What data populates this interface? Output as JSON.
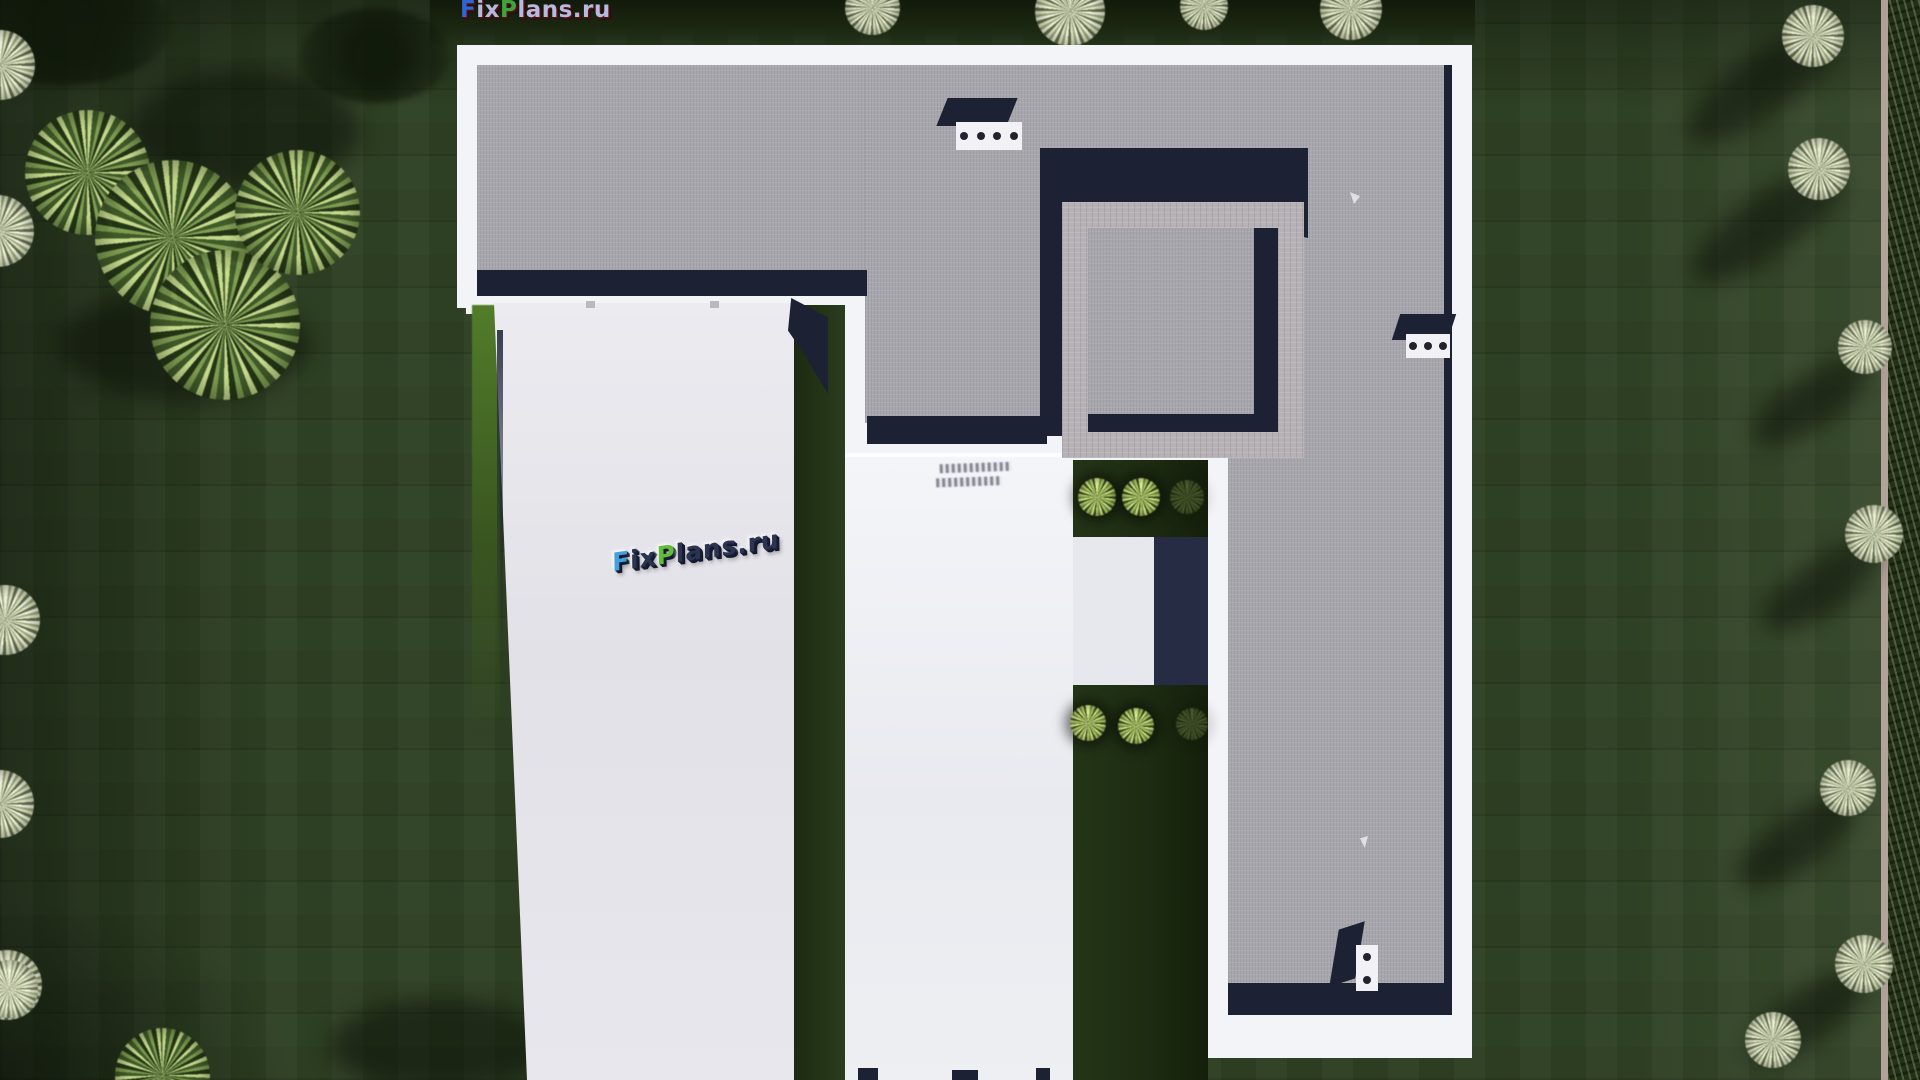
{
  "site": {
    "name": "FixPlans.ru"
  },
  "logo": {
    "full": "FixPlans.ru",
    "parts": [
      {
        "text": "F",
        "color": "#2f66d4"
      },
      {
        "text": "ix",
        "color": "#b6bade"
      },
      {
        "text": "P",
        "color": "#3fa33c"
      },
      {
        "text": "lans",
        "color": "#b6bade"
      },
      {
        "text": ".ru",
        "color": "#b6bade"
      }
    ]
  },
  "watermark3d": {
    "text": "FixPlans.ru"
  },
  "render": {
    "description": "Top-down aerial 3D render of a modern flat-roof L-shaped house with white parapets, gray gravel roof, raised square roof-light court, two light concrete drive strips, inner garden courts with round bushes, lawn with mowing pattern, trees and a boundary hedge",
    "roof_vents": [
      {
        "holes": 4
      },
      {
        "holes": 3
      },
      {
        "holes": 2
      }
    ],
    "courtyard_bushes": 6,
    "colors": {
      "lawn": "#2e4023",
      "roof_gravel": "#a8a7ad",
      "parapet_white": "#f3f4f7",
      "shadow_navy": "#1c2134",
      "driveway": "#e3e3e9",
      "brick_ring": "#b6b1b5",
      "boundary_line": "#c8b3ad",
      "bush_green": "#bcd574"
    }
  }
}
